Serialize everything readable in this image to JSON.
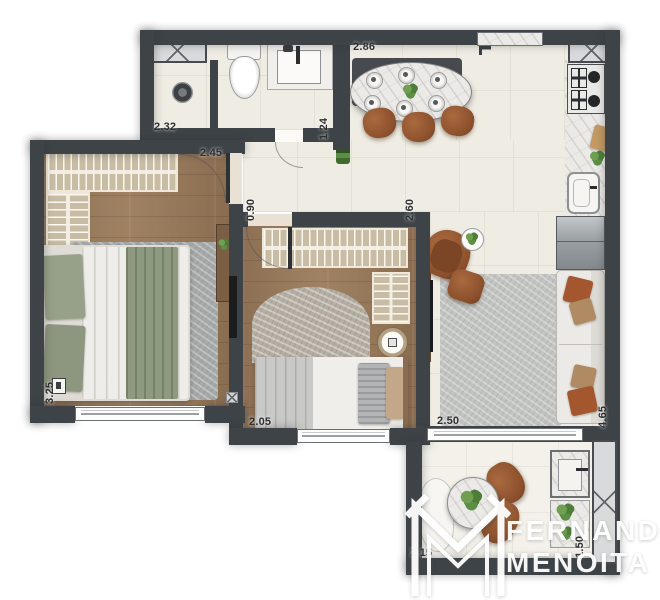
{
  "meta": {
    "type": "apartment-floor-plan-render",
    "view": "top-down furnished plan",
    "wall_color": "#3e4347",
    "wood_floor_color": "#97795c",
    "tile_floor_color": "#efece3",
    "accent_furniture_color": "#9c5c35",
    "bedding_accent_color": "#8d9a80"
  },
  "watermark": {
    "line1": "FERNANDO",
    "line2": "MENOITA",
    "monogram": "FM-chevron-monogram",
    "color": "#ffffff"
  },
  "dimensions": {
    "dining_width": "2.86",
    "bathroom_width": "2.32",
    "bedroom1_width": "2.45",
    "bathroom_depth": "1.24",
    "hall_width": "0.90",
    "living_width": "2.60",
    "bedroom1_length": "3.25",
    "bedroom2_width": "2.05",
    "living_window_width": "2.50",
    "living_length": "4.65",
    "balcony_width": "2.15",
    "balcony_counter_length": "1.50"
  },
  "rooms": {
    "bathroom": [
      "shaft",
      "shower-drain",
      "toilet",
      "vanity-sink"
    ],
    "bedroom1": [
      "open-closet-hangers",
      "open-closet-shelves",
      "double-bed",
      "rug",
      "plant",
      "tv-panel",
      "console"
    ],
    "bedroom2": [
      "open-closet-hangers",
      "side-closet",
      "single-bed",
      "half-round-rug",
      "round-side-table"
    ],
    "living_dining": [
      "oval-dining-table",
      "dining-chairs",
      "vertical-garden",
      "armchair",
      "ottoman",
      "side-table-plant",
      "rug",
      "sofa",
      "tv-panel"
    ],
    "kitchen": [
      "shaft",
      "cooktop",
      "counter",
      "cutting-board",
      "plant",
      "sink",
      "refrigerator"
    ],
    "balcony": [
      "lounge-chair",
      "round-table",
      "plant",
      "chairs",
      "gourmet-counter-sink",
      "planter-shelf",
      "shaft"
    ]
  }
}
